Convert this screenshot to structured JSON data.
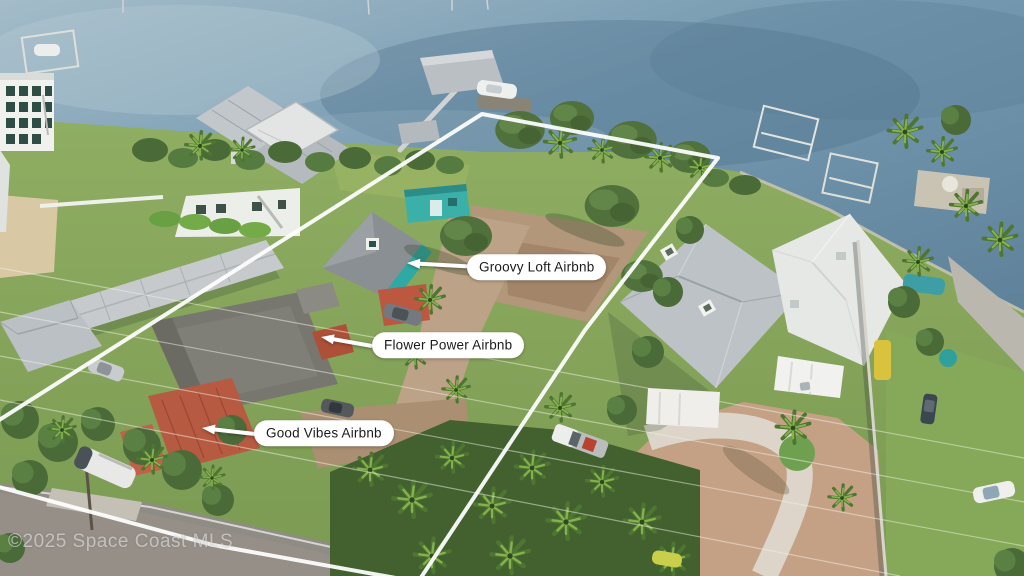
{
  "image": {
    "type": "aerial-drone-photo",
    "description": "Aerial view of a waterfront vacant lot outlined in white, flanked by Airbnb cottages, neighboring homes, docks and the Indian River",
    "watermark": "©2025 Space Coast MLS"
  },
  "annotations": {
    "labels": [
      {
        "id": "groovy-loft",
        "text": "Groovy Loft Airbnb"
      },
      {
        "id": "flower-power",
        "text": "Flower Power Airbnb"
      },
      {
        "id": "good-vibes",
        "text": "Good Vibes Airbnb"
      }
    ],
    "boundary": "white property outline"
  },
  "colors": {
    "label-bg": "#ffffff",
    "label-text": "#1b1b1b",
    "boundary-line": "#ffffff",
    "arrow": "#ffffff",
    "water": "#6d93ab",
    "teal-cottage": "#3bb0a9",
    "red-tile-roof": "#b65a41",
    "grass": "#84a757",
    "dirt": "#b2977a",
    "metal-roof": "#bcc2c6",
    "paver-driveway": "#c4a184"
  }
}
